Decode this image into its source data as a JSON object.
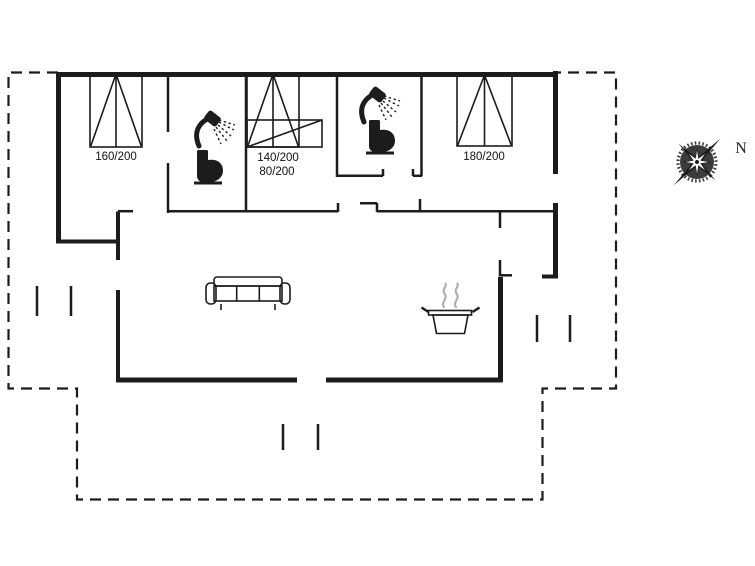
{
  "plan": {
    "title": "holiday-house-floor-plan",
    "beds": [
      {
        "name": "double-bed-bedroom-1",
        "label": "160/200"
      },
      {
        "name": "double-bed-bedroom-2",
        "label": "140/200"
      },
      {
        "name": "bunk-bed-bedroom-2",
        "label": "80/200"
      },
      {
        "name": "double-bed-bedroom-3",
        "label": "180/200"
      }
    ],
    "compass": {
      "north_label": "N"
    },
    "icons": [
      "shower-icon",
      "toilet-icon",
      "shower-icon",
      "toilet-icon",
      "sofa-icon",
      "cooking-pot-icon",
      "compass-rose-icon"
    ]
  },
  "colors": {
    "line": "#1c1c1c",
    "steam": "#b0b0b0",
    "compass": "#3b3b3b",
    "background": "#ffffff"
  }
}
